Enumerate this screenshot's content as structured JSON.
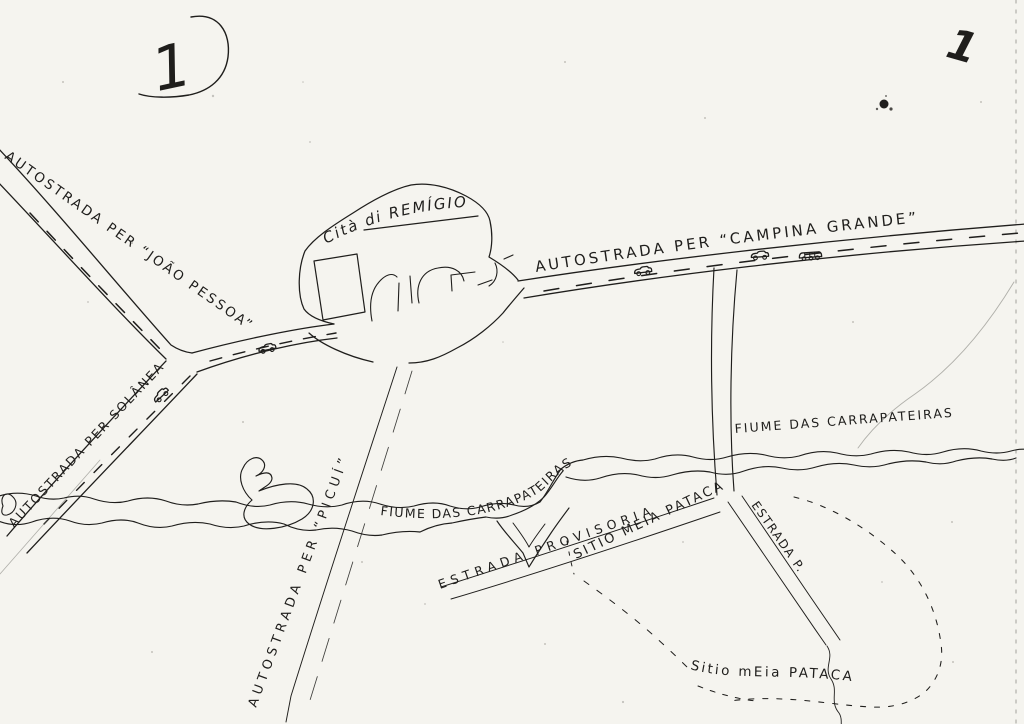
{
  "page": {
    "number": "1",
    "corner_mark": "1"
  },
  "colors": {
    "ink": "#1f1e1c",
    "paper": "#f5f4ef"
  },
  "map": {
    "city": {
      "label": "Cità di REMÍGIO"
    },
    "roads": {
      "joao_pessoa": "AUTOSTRADA PER “JOÃO PESSOA”",
      "solanea": "AUTOSTRADA PER SOLÂNEA",
      "campina_grande": "AUTOSTRADA PER “CAMPINA GRANDE”",
      "picui": "AUTOSTRADA PER “PICUÍ”",
      "provisoria": "ESTRADA PROVISORIA",
      "estrada_p": "ESTRADA P."
    },
    "rivers": {
      "carrapateiras_west": "FIUME DAS CARRAPATEIRAS",
      "carrapateiras_east": "FIUME DAS CARRAPATEIRAS"
    },
    "places": {
      "sitio_meia_pataca_upper": "SITIO MEIA PATACA",
      "sitio_meia_pataca_lower": "Sitio mEia PATACA"
    },
    "icons": {
      "vehicles": [
        "car-icon",
        "car-icon",
        "car-icon",
        "car-icon",
        "truck-icon"
      ]
    }
  }
}
